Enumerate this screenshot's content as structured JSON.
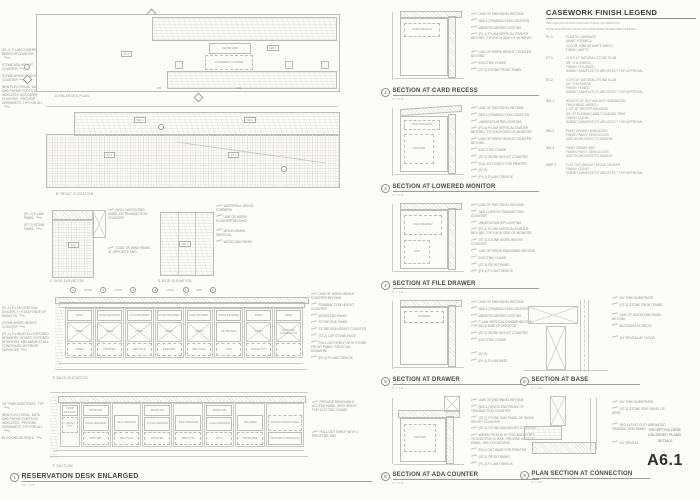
{
  "sheet": {
    "number": "A6.1",
    "title_block": {
      "line1": "RECEPTION DESK",
      "line2": "ENLARGED PLANS,",
      "line3": "DETAILS"
    }
  },
  "legend": {
    "title": "CASEWORK FINISH LEGEND",
    "note1": "SEE SPECIFICATIONS FOR ADDITIONAL INFORMATION",
    "note2": "NOTE: ELEVATION CALLOUTS SUPERSEDE SCHEDULED FINISHES",
    "items": [
      {
        "tag": "PL-1",
        "desc": "PLASTIC LAMINATE\nMANF: FORMICA\nCOLOR: 9285-58 WHITE BIRCH\nFINISH: MATTE"
      },
      {
        "tag": "ST-1",
        "desc": "CUT/CUT NATURAL STONE SLAB\n3/4\" THICKNESS\nFINISH: POLISHED\nSUBMIT SAMPLES TO ARCHITECT FOR APPROVAL"
      },
      {
        "tag": "ST-2",
        "desc": "CUT/CUT NATURAL STONE SLAB\n3/4\" THICKNESS\nFINISH: HONED\nSUBMIT SAMPLES TO ARCHITECT FOR APPROVAL"
      },
      {
        "tag": "WD-1",
        "desc": "SOLID FLAT CUT WALNUT HARDWOOD\nTHICKNESS VARIES:\n1-1/2\" AT RECEPTION DESK\n3/4\" AT RUNNING AND STANDING TRIM\nFINISH: CLEAR\nSUBMIT SAMPLES TO ARCHITECT FOR APPROVAL"
      },
      {
        "tag": "WD-2",
        "desc": "PAINT GRADE HARDWOOD\nFINISH: PAINT, SEMI-GLOSS\nMATCH ARCHITECT'S SAMPLE"
      },
      {
        "tag": "WD-3",
        "desc": "PAINT GRADE MDF\nFINISH: PAINT, SEMI-GLOSS\nMATCH ARCHITECT'S SAMPLE"
      },
      {
        "tag": "WDP-1",
        "desc": "FLAT CUT WALNUT WOOD VENEER\nFINISH: CLEAR\nSUBMIT SAMPLES TO ARCHITECT FOR APPROVAL"
      }
    ]
  },
  "views": {
    "a": {
      "label": "A  ENLARGED PLAN",
      "callouts": [
        "(PL-1) P-LAM LOWERED MONITOR COUNTER, TYP",
        "STONE ADA HEIGHT COUNTER",
        "STONE WORK HEIGHT COUNTER",
        "NEW ELECTRICAL, DATA AND PHONE PORTS AS INDICATED ON LOWER COUNTER - PROVIDE GROMMETS, TYP FOR ALL"
      ],
      "keyboard": "KEYBOARD",
      "lowered": "LOWERED COUNTER",
      "tag1": "ST-1",
      "tag2": "WD-1",
      "dim1": "EQ",
      "dim2": "EQ"
    },
    "b": {
      "label": "B  FRONT ELEVATION",
      "t1": "WD-1",
      "t2": "WD-1",
      "t3": "ST-2",
      "t4": "ST-2"
    },
    "c": {
      "label": "C  SIDE ELEVATION",
      "tag": "ST-2",
      "left": [
        "(PL-1) P-LAM PANEL",
        "(ST-2) STONE PANEL"
      ],
      "right": [
        "(WD-1) WOOD END PANEL OF TRANSACTION COUNTER",
        "EDGE OF WING PANEL AT OPPOSITE END"
      ]
    },
    "d": {
      "label": "D  SIDE ELEVATION",
      "tag": "WD-1",
      "callouts": [
        "WATERFALL WOOD CORNERS",
        "LINE OF WORK COUNTER BEYOND",
        "WOOD GRAIN, VERTICAL",
        "WOOD END PANEL"
      ]
    },
    "e": {
      "label": "E  BACK ELEVATION",
      "markers": [
        {
          "n": "4",
          "note": "LOCK"
        },
        {
          "n": "5",
          "note": "LOCK"
        },
        {
          "n": "3",
          "note": ""
        },
        {
          "n": "5",
          "note": "LOCK"
        },
        {
          "n": "4",
          "note": "SIM"
        },
        {
          "n": "2",
          "note": ""
        }
      ],
      "left": [
        "(PL-1) P-LAM VERTICAL DIVIDER, TYP EACH SIDE OF MONITOR",
        "STONE WORK HEIGHT COUNTER",
        "(PL-1) P-LAM AT ALL EXPOSED DRAWERS, DOORS, EXPOSED INTERIORS. MELAMINE AT ALL CONCEALED INTERIOR SURFACES"
      ],
      "right": [
        "LINE OF WORK HEIGHT COUNTER BEYOND",
        "TRANSACTION HEIGHT COUNTER",
        "WOOD END PANEL",
        "STONE END PANEL",
        "STONE ADA HEIGHT COUNTER",
        "(ST-2) LAP STONE EDGE",
        "PULL-OUT SHELF WITH STONE FRONT PANEL, SIM AT ALL DRAWERS",
        "(PL-1) P-LAM TOEKICK"
      ],
      "cells": [
        {
          "top": "OPEN",
          "mid": "OPEN",
          "bot": "OPEN"
        },
        {
          "top": "CASH DRAWER",
          "mid": "OPEN",
          "bot": "PRINTER"
        },
        {
          "top": "FILE DRAWER",
          "mid": "OPEN",
          "bot": "RECYCLE"
        },
        {
          "top": "CASH DRAWER",
          "mid": "OPEN",
          "bot": "PRINTER"
        },
        {
          "top": "FILE DRAWER",
          "mid": "OPEN",
          "bot": "RECYCLE"
        },
        {
          "top": "CASH DRAWER",
          "mid": "KEYBOARD",
          "bot": "CPU"
        },
        {
          "top": "OPEN",
          "mid": "OPEN",
          "bot": "TRASH TYP"
        },
        {
          "top": "OPEN",
          "mid": "PRINTER COPIER FAX",
          "bot": ""
        }
      ]
    },
    "f": {
      "label": "F  SECTION",
      "left": [
        "3/4\" PWD SUBSTRATE, TYP",
        "NEW ELECTRICAL, DATA AND PHONE PORTS AS INDICATED - PROVIDE GROMMETS, TYP FOR ALL",
        "BLOCKING AS REQ'D"
      ],
      "right": [
        "PROVIDE REMOVABLE ACCESS PANEL WITH SPACE FOR ELECTRIC CHASE",
        "PULL-OUT SHELF WITH 2 PRINTERS, SIM"
      ],
      "cells": [
        {
          "top": "CARD RECESS",
          "mid": "TRASH TYP",
          "bot": ""
        },
        {
          "top": "MONITOR",
          "mid": "CASH DRAWER",
          "bot": "PRINTER"
        },
        {
          "top": "",
          "mid": "FILE DRAWER",
          "bot": "RECYCLE"
        },
        {
          "top": "MONITOR",
          "mid": "CASH DRAWER",
          "bot": "PRINTER"
        },
        {
          "top": "",
          "mid": "FILE DRAWER",
          "bot": "RECYCLE"
        },
        {
          "top": "MONITOR",
          "mid": "CASH DRAWER",
          "bot": "CPU"
        },
        {
          "top": "",
          "mid": "DRAWER",
          "bot": "KEYBOARD"
        },
        {
          "top": "",
          "mid": "DATA ACCESS PANEL",
          "bot": "PRINTER COPIER FAX"
        }
      ]
    }
  },
  "main_view": {
    "number": "1",
    "title": "RESERVATION DESK ENLARGED",
    "scale": "3/4\" = 1'-0\""
  },
  "sections": [
    {
      "number": "2",
      "title": "SECTION AT CARD RECESS",
      "scale": "3\" = 1'-0\"",
      "interior": [
        "CARD RECESS"
      ],
      "callouts": [
        "LINE OF END PANEL BEYOND",
        "(WD-1) TRANSACTION COUNTER",
        "UNDERCOUNTER LIGHTING",
        "(PL-1) P-LAM VERTICAL DIVIDER BEYOND, TYP EACH SIDE OF MONITOR",
        "LINE OF WORK HEIGHT COUNTER BEYOND",
        "ELECTRIC CHASE",
        "(ST-2) STONE FRONT PANEL"
      ]
    },
    {
      "number": "3",
      "title": "SECTION AT LOWERED MONITOR",
      "scale": "3\" = 1'-0\"",
      "interior": [
        "CASH DRAWER",
        "PRINTER"
      ],
      "callouts": [
        "LINE OF END PANEL BEYOND",
        "(WD-1) TRANSACTION COUNTER",
        "UNDERCOUNTER LIGHTING",
        "(PL-1) P-LAM VERTICAL DIVIDER BEYOND, TYP EACH SIDE OF MONITOR",
        "LINE OF WORK HEIGHT COUNTER BEYOND",
        "ELECTRIC CHASE",
        "(ST-1) WORK HEIGHT COUNTER",
        "FULL EXT SHELF FOR PRINTER",
        "(ST-2)",
        "(PL-1) P-LAM TOEKICK"
      ]
    },
    {
      "number": "4",
      "title": "SECTION AT FILE DRAWER",
      "scale": "3\" = 1'-0\"",
      "interior": [
        "FILE DRAWER",
        "CPU"
      ],
      "callouts": [
        "LINE OF END PANEL BEYOND",
        "(WD-1) WOOD TRANSACTION COUNTER",
        "UNDERCOUNTER LIGHTING",
        "(PL-1) P-LAM VERTICAL DIVIDER BEYOND, TYP EACH SIDE OF MONITOR",
        "(ST-1) STONE WORK HEIGHT COUNTER",
        "LINE OF WOOD END PANEL BEYOND",
        "ELECTRIC CHASE",
        "(ST-2) FRONT PANEL",
        "(PL-1) P-LAM TOEKICK"
      ]
    },
    {
      "number": "5",
      "title": "SECTION AT DRAWER",
      "scale": "3\" = 1'-0\"",
      "interior": [
        "DRAWER"
      ],
      "callouts": [
        "LINE OF END PANEL BEYOND",
        "(WD-1) TRANSACTION COUNTER",
        "UNDERCOUNTER LIGHTING",
        "P-LAM VERTICAL DIVIDER BEYOND, TYP EACH SIDE OF MONITOR",
        "(ST-1) WORK HEIGHT COUNTER",
        "ELECTRIC CHASE",
        "(ST-2)",
        "(PL-1) P-LAM BASE"
      ]
    },
    {
      "number": "6",
      "title": "SECTION AT ADA COUNTER",
      "scale": "3\" = 1'-0\"",
      "interior": [
        "PRINTER"
      ],
      "callouts": [
        "LINE OF END PANEL BEYOND",
        "(WD-1) WOOD END PANEL OF TRANSACTION COUNTER",
        "(ST-2) STONE END PANEL OF WORK HEIGHT COUNTER",
        "(ST-1) STONE ADA HEIGHT COUNTER",
        "WIRES FROM ELECTRIC/DATA PORT TO ELECTRIC CHASE, PROVIDE ACCESS PANEL, SEE ELEVATIONS",
        "PULL-OUT BASE FOR PRINTER",
        "(ST-2) FRONT PANEL",
        "(PL-1) P-LAM TOEKICK"
      ]
    },
    {
      "number": "8",
      "title": "SECTION AT BASE",
      "scale": "6\" = 1'-0\"",
      "interior": [],
      "callouts": [
        "3/4\" PWD SUBSTRATE",
        "(ST-2) STONE FRONT PANEL",
        "LINE OF WOOD END PANEL BEYOND",
        "BLOCKING AS REQ'D",
        "1/4\" REVEAL AT FLOOR"
      ]
    },
    {
      "number": "9",
      "title": "PLAN SECTION AT CONNECTION",
      "scale": "6\" = 1'-0\"",
      "interior": [],
      "callouts": [
        "3/4\" PWD SUBSTRATE",
        "(ST-2) STONE SIDE PANEL OF DESK",
        "(WD-1) FLAT CUT HARDWOOD TRANSACTION PANEL",
        "1/4\" REVEAL"
      ]
    }
  ]
}
